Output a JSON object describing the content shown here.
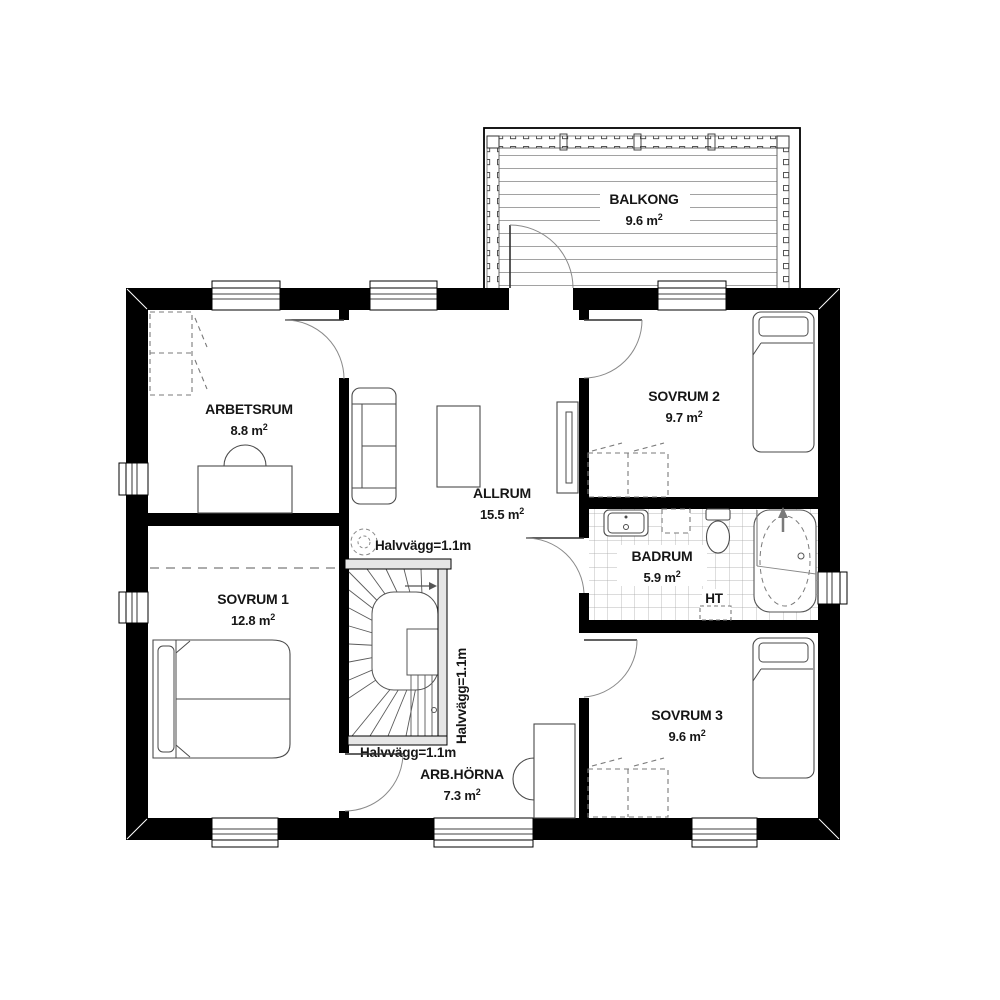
{
  "plan": {
    "rooms": [
      {
        "id": "balkong",
        "name": "BALKONG",
        "area": "9.6 m",
        "sup": "2"
      },
      {
        "id": "arbetsrum",
        "name": "ARBETSRUM",
        "area": "8.8 m",
        "sup": "2"
      },
      {
        "id": "sovrum2",
        "name": "SOVRUM 2",
        "area": "9.7 m",
        "sup": "2"
      },
      {
        "id": "allrum",
        "name": "ALLRUM",
        "area": "15.5 m",
        "sup": "2"
      },
      {
        "id": "badrum",
        "name": "BADRUM",
        "area": "5.9 m",
        "sup": "2"
      },
      {
        "id": "sovrum1",
        "name": "SOVRUM 1",
        "area": "12.8 m",
        "sup": "2"
      },
      {
        "id": "sovrum3",
        "name": "SOVRUM 3",
        "area": "9.6 m",
        "sup": "2"
      },
      {
        "id": "arbhorna",
        "name": "ARB.HÖRNA",
        "area": "7.3 m",
        "sup": "2"
      }
    ],
    "annotations": {
      "half_wall": "Halvvägg=1.1m",
      "towel_dryer": "HT"
    },
    "colors": {
      "wall": "#000000",
      "background": "#ffffff",
      "furniture_line": "#4a4a4a",
      "tile_line": "#a3a3a3"
    }
  }
}
